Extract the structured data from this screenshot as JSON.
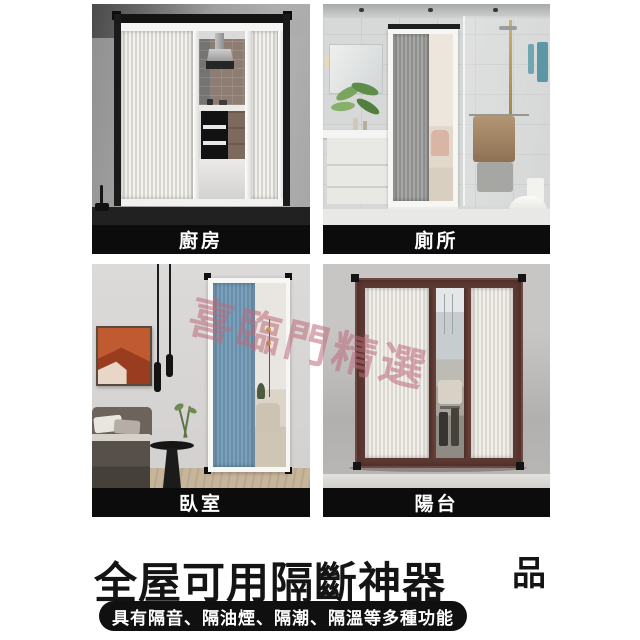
{
  "watermark": {
    "text": "喜臨門精選"
  },
  "quadrants": {
    "kitchen": {
      "label": "廚房"
    },
    "toilet": {
      "label": "廁所"
    },
    "bedroom": {
      "label": "臥室"
    },
    "balcony": {
      "label": "陽台"
    }
  },
  "footer": {
    "title": "全屋可用隔斷神器",
    "side_char": "品",
    "pill_text": "具有隔音、隔油煙、隔潮、隔溫等多種功能"
  },
  "colors": {
    "pageBg": "#ffffff",
    "labelBarBg": "#0c0c0c",
    "labelText": "#ffffff",
    "titleColor": "#141414",
    "pillBg": "#101010",
    "pillText": "#ffffff",
    "watermarkColor": "rgba(187,106,122,0.55)",
    "blueDoor": "#7ba0bb",
    "brownFrame": "#5e3a33",
    "tealTowel": "#5d97a5",
    "accentOrange": "#c05a30"
  }
}
